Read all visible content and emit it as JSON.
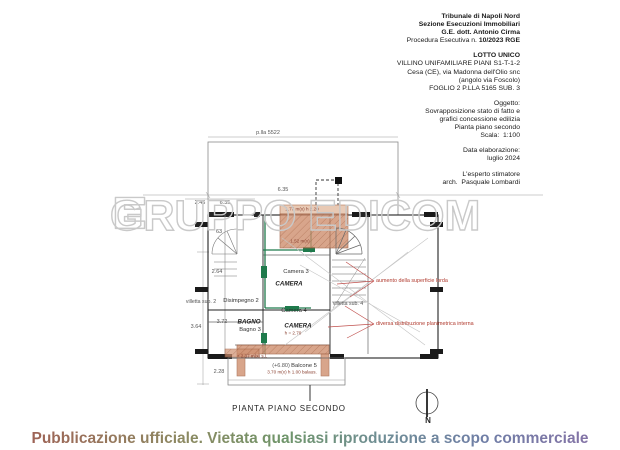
{
  "header": {
    "lines": [
      {
        "text": "Tribunale di Napoli Nord",
        "bold": true
      },
      {
        "text": "Sezione Esecuzioni Immobiliari",
        "bold": true
      },
      {
        "text": "G.E. dott. Antonio Cirma",
        "bold": true
      },
      {
        "pre": "Procedura Esecutiva n. ",
        "bold_text": "10/2023 RGE"
      },
      {
        "text": ""
      },
      {
        "text": "LOTTO UNICO",
        "bold": true
      },
      {
        "text": "VILLINO UNIFAMILIARE PIANI S1-T-1-2"
      },
      {
        "text": "Cesa (CE), via Madonna dell'Olio snc"
      },
      {
        "text": "(angolo via Foscolo)"
      },
      {
        "text": "FOGLIO 2 P.LLA 5165 SUB. 3"
      },
      {
        "text": ""
      },
      {
        "text": "Oggetto:"
      },
      {
        "text": "Sovrapposizione stato di fatto e"
      },
      {
        "text": "grafici concessione edilizia"
      },
      {
        "text": "Pianta piano secondo"
      },
      {
        "text": "Scala:  1:100"
      },
      {
        "text": ""
      },
      {
        "text": "Data elaborazione:"
      },
      {
        "text": "luglio 2024"
      },
      {
        "text": ""
      },
      {
        "text": "L'esperto stimatore"
      },
      {
        "text": "arch.  Pasquale Lombardi"
      }
    ]
  },
  "watermark": {
    "text": "GRUPPO EDICOM"
  },
  "plan": {
    "labels": [
      {
        "text": "p.lla 5522",
        "x": 268,
        "y": 133,
        "cls": "dim"
      },
      {
        "text": "6.35",
        "x": 283,
        "y": 190,
        "cls": "dim"
      },
      {
        "text": "2.46",
        "x": 200,
        "y": 203,
        "cls": "dim"
      },
      {
        "text": "6.35",
        "x": 225,
        "y": 203,
        "cls": "dim"
      },
      {
        "text": "63",
        "x": 219,
        "y": 232,
        "cls": "dim"
      },
      {
        "text": "2.64",
        "x": 217,
        "y": 272,
        "cls": "dim"
      },
      {
        "text": "3.64",
        "x": 196,
        "y": 327,
        "cls": "dim"
      },
      {
        "text": "3.72",
        "x": 222,
        "y": 322,
        "cls": "dim"
      },
      {
        "text": "2.28",
        "x": 219,
        "y": 372,
        "cls": "dim"
      },
      {
        "text": "Camera 3",
        "x": 296,
        "y": 272,
        "cls": "room"
      },
      {
        "text": "Camera 4",
        "x": 294,
        "y": 311,
        "cls": "room"
      },
      {
        "text": "Disimpegno 2",
        "x": 241,
        "y": 301,
        "cls": "room"
      },
      {
        "text": "Bagno 3",
        "x": 250,
        "y": 330,
        "cls": "room"
      },
      {
        "text": "Balcone 5",
        "x": 304,
        "y": 366,
        "cls": "room"
      },
      {
        "text": "(+6.80)",
        "x": 281,
        "y": 366,
        "cls": "dim"
      },
      {
        "text": "villetta sub. 2",
        "x": 201,
        "y": 302,
        "cls": "small"
      },
      {
        "text": "villetta sub. 4",
        "x": 348,
        "y": 304,
        "cls": "small"
      },
      {
        "text": "CAMERA",
        "x": 289,
        "y": 284,
        "cls": "sdf"
      },
      {
        "text": "CAMERA",
        "x": 298,
        "y": 326,
        "cls": "sdf"
      },
      {
        "text": "BAGNO",
        "x": 249,
        "y": 322,
        "cls": "sdf"
      },
      {
        "text": "1.77 m(x) h 2.20",
        "x": 302,
        "y": 209,
        "cls": "tiny"
      },
      {
        "text": "1.52 m(x)",
        "x": 300,
        "y": 241,
        "cls": "tiny"
      },
      {
        "text": "h = 2.70",
        "x": 293,
        "y": 333,
        "cls": "tiny"
      },
      {
        "text": "+ 2.37 m(x) s.l.",
        "x": 252,
        "y": 356,
        "cls": "tiny"
      },
      {
        "text": "3.70 m(x) h 1.00 balaus.",
        "x": 292,
        "y": 372,
        "cls": "tiny"
      },
      {
        "text": "aumento della superficie lorda",
        "x": 376,
        "y": 281,
        "cls": "ann"
      },
      {
        "text": "diversa distribuzione planimetrica interna",
        "x": 376,
        "y": 324,
        "cls": "ann"
      }
    ]
  },
  "caption": "PIANTA PIANO SECONDO",
  "north_label": "N",
  "banner": {
    "text": "Pubblicazione ufficiale. Vietata qualsiasi riproduzione a scopo commerciale"
  },
  "colors": {
    "terracotta": "#cf8f6f",
    "state_green": "#1f7a4c",
    "annotation_red": "#b03a2e",
    "watermark_gray": "#c9c9c9"
  }
}
